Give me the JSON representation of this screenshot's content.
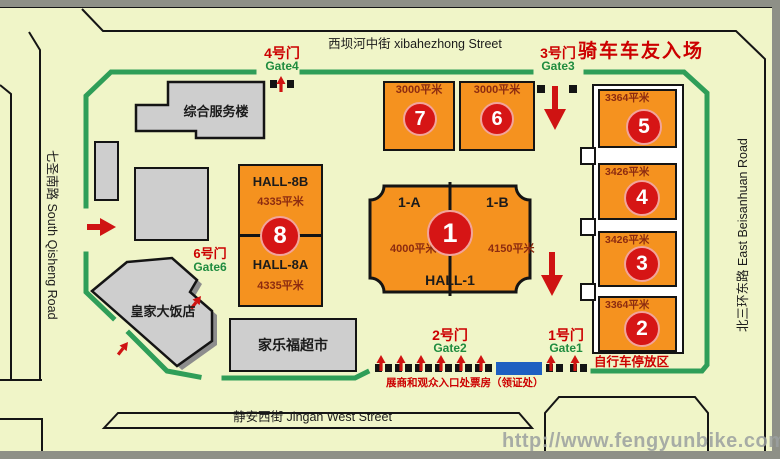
{
  "streets": {
    "top": "西坝河中街  xibahezhong Street",
    "left": "七圣南路  South Qisheng Road",
    "right": "北三环东路  East Beisanhuan Road",
    "bottom": "静安西街  Jingan West Street"
  },
  "gates": {
    "g4": {
      "cn": "4号门",
      "en": "Gate4"
    },
    "g3": {
      "cn": "3号门",
      "en": "Gate3"
    },
    "g6": {
      "cn": "6号门",
      "en": "Gate6"
    },
    "g2": {
      "cn": "2号门",
      "en": "Gate2"
    },
    "g1": {
      "cn": "1号门",
      "en": "Gate1"
    }
  },
  "buildings": {
    "service": "综合服务楼",
    "hotel": "皇家大饭店",
    "supermarket": "家乐福超市"
  },
  "halls": {
    "h7": {
      "num": "7",
      "area": "3000平米"
    },
    "h6": {
      "num": "6",
      "area": "3000平米"
    },
    "h5": {
      "num": "5",
      "area": "3364平米"
    },
    "h4": {
      "num": "4",
      "area": "3426平米"
    },
    "h3": {
      "num": "3",
      "area": "3426平米"
    },
    "h2": {
      "num": "2",
      "area": "3364平米"
    },
    "h8": {
      "num": "8",
      "hall_b": "HALL-8B",
      "hall_b_area": "4335平米",
      "hall_a": "HALL-8A",
      "hall_a_area": "4335平米"
    },
    "h1": {
      "num": "1",
      "name": "HALL-1",
      "zone_a": "1-A",
      "zone_b": "1-B",
      "zone_a_area": "4000平米",
      "zone_b_area": "4150平米"
    }
  },
  "annotations": {
    "riders_entrance": "骑车车友入场",
    "visitors_entrance": "展商和观众入口处",
    "ticket_office": "票房（领证处）",
    "bike_parking": "自行车停放区",
    "watermark": "http://www.fengyunbike.com"
  },
  "colors": {
    "map_background": "#f0f5c8",
    "venue_border_green": "#2f9e58",
    "hall_orange": "#f5921f",
    "circle_red": "#d61515",
    "building_gray": "#cecece",
    "ticket_blue": "#1e5fc1",
    "annotation_red": "#cc0000",
    "gate_label_green": "#1f8c3f",
    "area_text_maroon": "#8c2b10",
    "watermark_gray": "#9ba0a0",
    "edge_gray": "#8e9087"
  }
}
